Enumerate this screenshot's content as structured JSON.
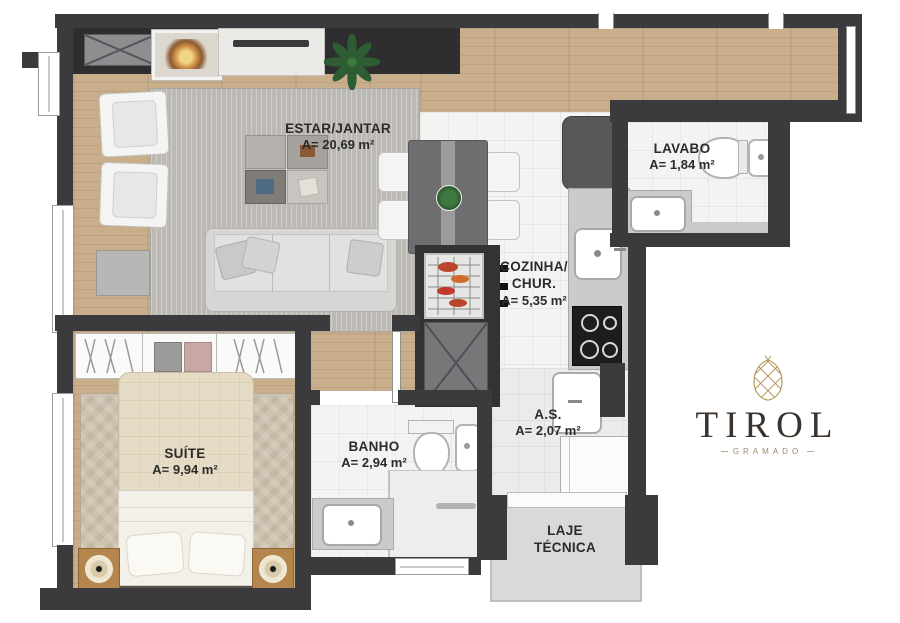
{
  "plan": {
    "rooms": {
      "estar": {
        "name": "ESTAR/JANTAR",
        "area": "A= 20,69 m²"
      },
      "lavabo": {
        "name": "LAVABO",
        "area": "A= 1,84 m²"
      },
      "cozinha": {
        "name": "COZINHA/ CHUR.",
        "area": "A= 5,35 m²"
      },
      "suite": {
        "name": "SUÍTE",
        "area": "A= 9,94 m²"
      },
      "banho": {
        "name": "BANHO",
        "area": "A= 2,94 m²"
      },
      "as": {
        "name": "A.S.",
        "area": "A= 2,07 m²"
      },
      "laje": {
        "name": "LAJE TÉCNICA"
      }
    },
    "logo": {
      "name": "TIROL",
      "location": "GRAMADO"
    },
    "colors": {
      "wall": "#3b3b3d",
      "wood_floor": "#c9ae8c",
      "tile_floor": "#f3f3f1",
      "living_rug": "#bcb9b4",
      "suite_rug": "#cdc1af",
      "brand_gold": "#b6995d",
      "brand_text": "#3b332c"
    }
  }
}
